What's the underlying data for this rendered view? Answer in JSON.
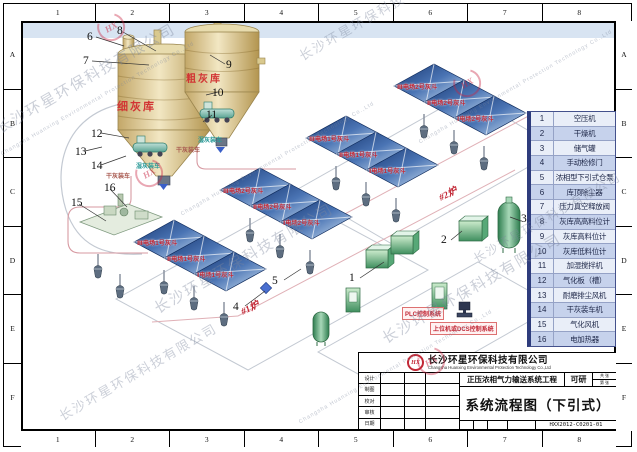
{
  "border": {
    "cols": [
      "1",
      "2",
      "3",
      "4",
      "5",
      "6",
      "7",
      "8"
    ],
    "rows": [
      "A",
      "B",
      "C",
      "D",
      "E",
      "F"
    ]
  },
  "watermark": {
    "company_cn": "长沙环星环保科技有限公司",
    "company_en": "Changsha Huanxing Environmental Protection Technology Co.,Ltd",
    "logo": "HX"
  },
  "diagram": {
    "silos": {
      "fine_label": "细灰库",
      "coarse_label": "粗灰库"
    },
    "loading": {
      "dry": "干灰装车",
      "wet": "湿灰装车"
    },
    "boilers": {
      "b1": "#1炉",
      "b2": "#2炉"
    },
    "control": {
      "plc": "PLC控制系统",
      "dcs": "上位机或DCS控制系统"
    },
    "hopper_groups": [
      {
        "panels": [
          "Ⅲ电场2号灰斗",
          "Ⅱ电场2号灰斗",
          "Ⅰ电场2号灰斗"
        ]
      },
      {
        "panels": [
          "Ⅲ电场1号灰斗",
          "Ⅱ电场1号灰斗",
          "Ⅰ电场1号灰斗"
        ]
      },
      {
        "panels": [
          "Ⅲ电场2号灰斗",
          "Ⅱ电场2号灰斗",
          "Ⅰ电场2号灰斗"
        ]
      },
      {
        "panels": [
          "Ⅲ电场1号灰斗",
          "Ⅱ电场1号灰斗",
          "Ⅰ电场1号灰斗"
        ]
      }
    ],
    "callouts": [
      "1",
      "2",
      "3",
      "4",
      "5",
      "6",
      "7",
      "8",
      "9",
      "10",
      "11",
      "12",
      "13",
      "14",
      "15",
      "16"
    ]
  },
  "legend": {
    "items": [
      {
        "no": "1",
        "name": "空压机"
      },
      {
        "no": "2",
        "name": "干燥机"
      },
      {
        "no": "3",
        "name": "储气罐"
      },
      {
        "no": "4",
        "name": "手动检修门"
      },
      {
        "no": "5",
        "name": "浓相型下引式仓泵"
      },
      {
        "no": "6",
        "name": "库顶除尘器"
      },
      {
        "no": "7",
        "name": "压力真空释放阀"
      },
      {
        "no": "8",
        "name": "灰库高高料位计"
      },
      {
        "no": "9",
        "name": "灰库高料位计"
      },
      {
        "no": "10",
        "name": "灰库低料位计"
      },
      {
        "no": "11",
        "name": "加湿搅拌机"
      },
      {
        "no": "12",
        "name": "气化板（槽）"
      },
      {
        "no": "13",
        "name": "耐磨排尘风机"
      },
      {
        "no": "14",
        "name": "干灰装车机"
      },
      {
        "no": "15",
        "name": "气化风机"
      },
      {
        "no": "16",
        "name": "电加热器"
      }
    ]
  },
  "titleblock": {
    "logo": "HX",
    "company_cn": "长沙环星环保科技有限公司",
    "company_en": "Changsha Huanxing Environmental Protection Technology Co.,Ltd",
    "project": "正压浓相气力输送系统工程",
    "stage": "可研",
    "sheet_total": "共 张",
    "sheet_no": "第 张",
    "title": "系统流程图（下引式）",
    "drawing_no": "HXX2012-C0201-01",
    "fields": [
      "设计",
      "制图",
      "校对",
      "审核",
      "日期"
    ]
  },
  "colors": {
    "accent_red": "#c22836",
    "panel_blue_dark": "#16356f",
    "panel_blue_light": "#d3e5f4",
    "legend_row_blue": "#c6d2ec",
    "equipment_green": "#3f8f5f",
    "silo_tan": "#d9c48a"
  }
}
